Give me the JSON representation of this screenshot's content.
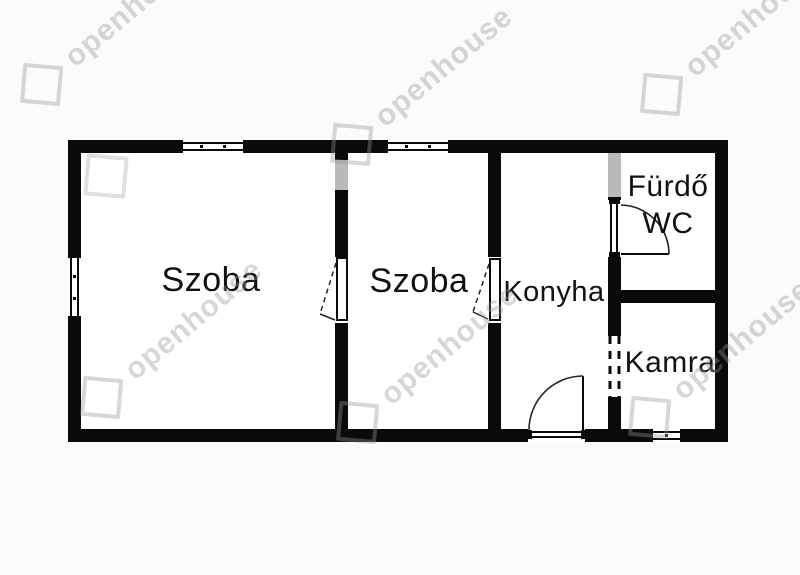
{
  "canvas": {
    "background": "#fbfbfb",
    "wall_color": "#0a0a0a"
  },
  "floorplan": {
    "type": "apartment-floor-plan",
    "rooms": [
      {
        "id": "szoba-1",
        "label": "Szoba"
      },
      {
        "id": "szoba-2",
        "label": "Szoba"
      },
      {
        "id": "konyha",
        "label": "Konyha"
      },
      {
        "id": "furdo-wc",
        "label_line_1": "Fürdő",
        "label_line_2": "WC"
      },
      {
        "id": "kamra",
        "label": "Kamra"
      }
    ],
    "symbols": {
      "windows": 4,
      "hinged_doors": 4,
      "dashed_openings": 1
    }
  },
  "watermark": {
    "text": "openhouse",
    "icon": "diamond-logo-icon",
    "tint": "#e3e3e3"
  }
}
